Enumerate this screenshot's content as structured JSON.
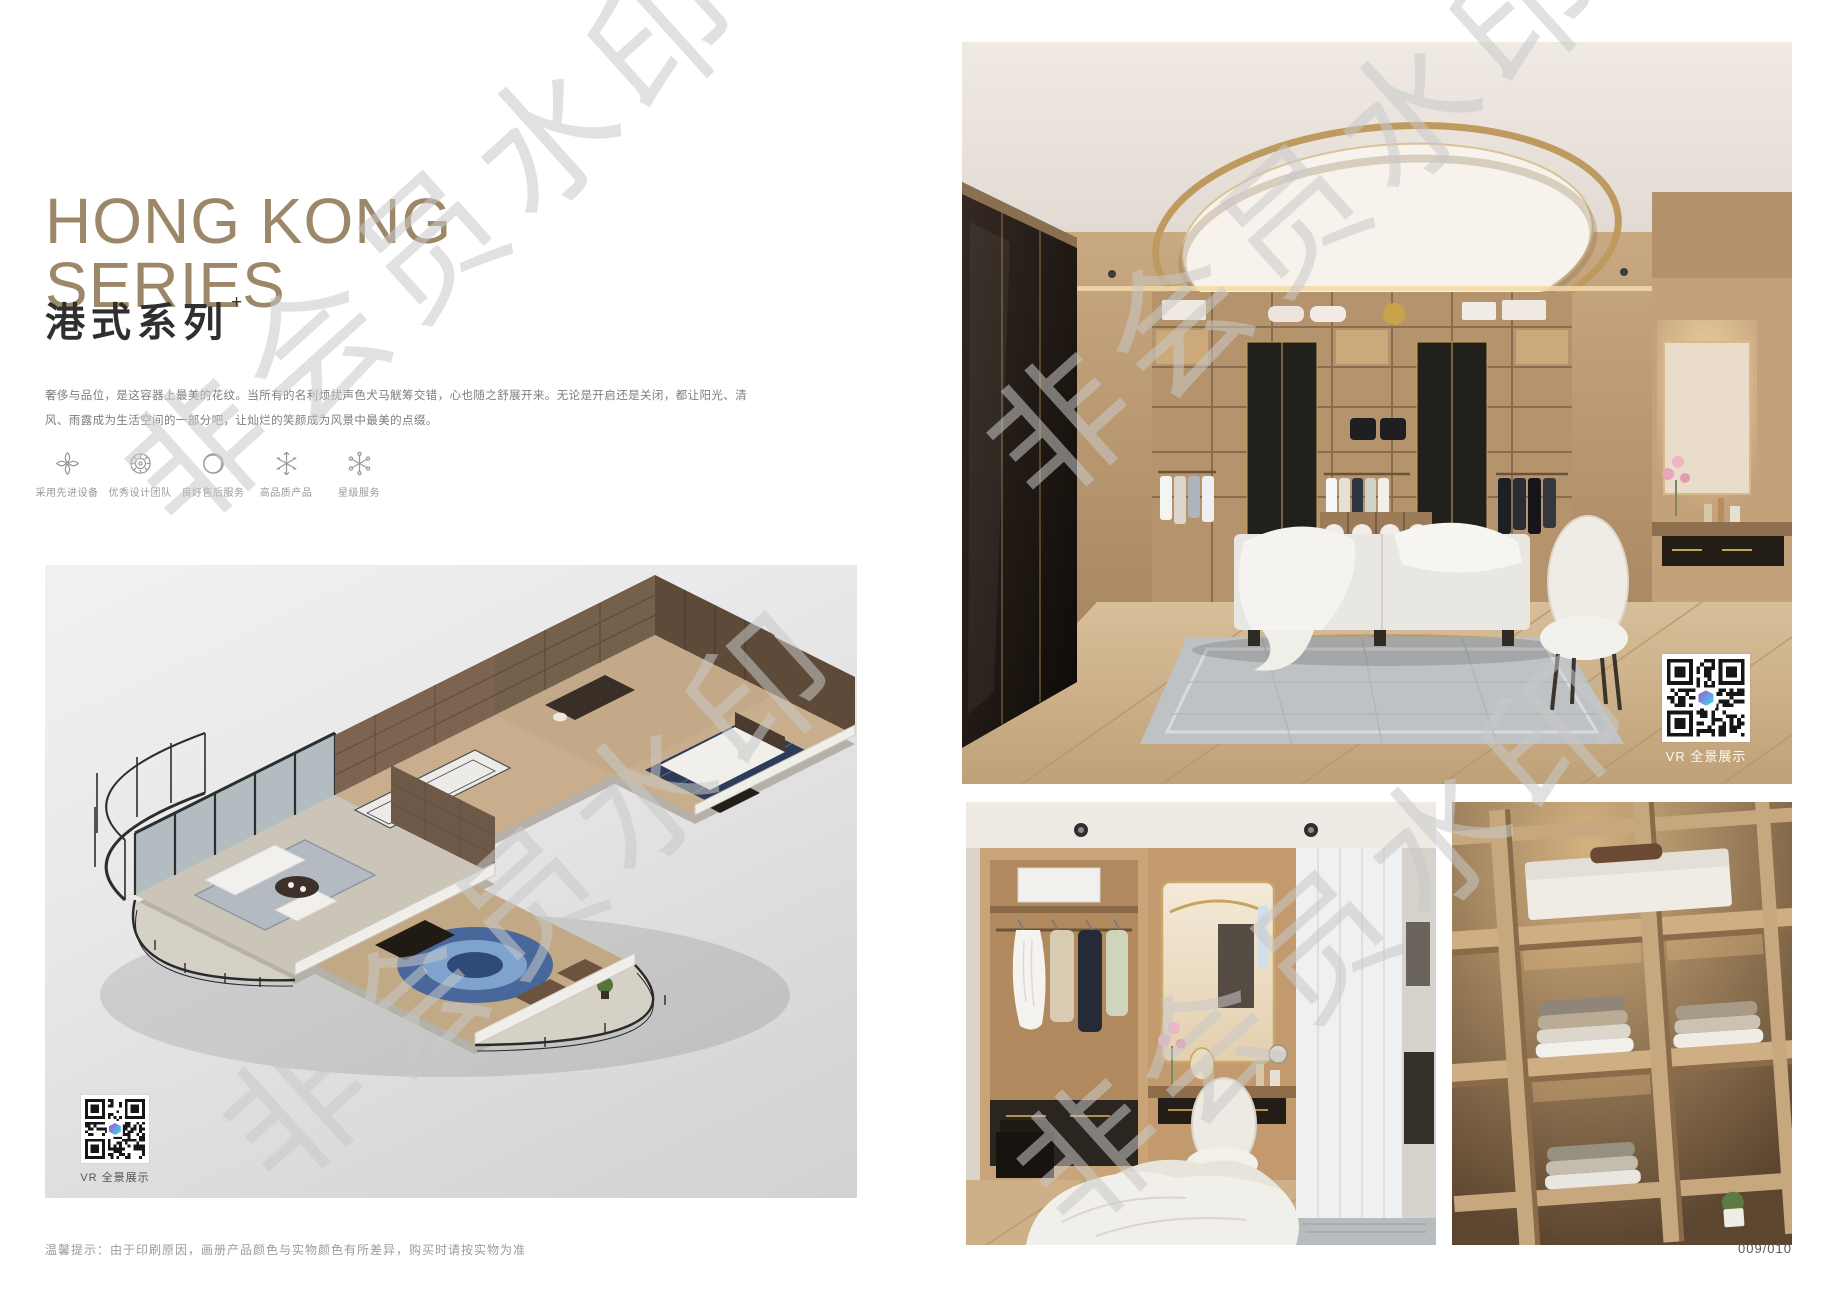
{
  "page": {
    "series_title": {
      "en_line1": "HONG KONG",
      "en_line2": "SERIES",
      "cn": "港式系列",
      "superscript": "+"
    },
    "description": {
      "line1": "奢侈与品位，是这容器上最美的花纹。当所有的名利烦扰声色犬马觥筹交错，心也随之舒展开来。无论是开启还是关闭，都让阳光、清",
      "line2": "风、雨露成为生活空间的一部分吧，让灿烂的笑颜成为风景中最美的点缀。"
    },
    "features": [
      {
        "icon": "ornament-flower-icon",
        "label": "采用先进设备"
      },
      {
        "icon": "rosette-icon",
        "label": "优秀设计团队"
      },
      {
        "icon": "ring-icon",
        "label": "良好售后服务"
      },
      {
        "icon": "snowflake-icon",
        "label": "高品质产品"
      },
      {
        "icon": "star-service-icon",
        "label": "星级服务"
      }
    ],
    "floorplan": {
      "vr_label": "VR 全景展示"
    },
    "main_photo": {
      "vr_label": "VR 全景展示"
    },
    "footer": {
      "note": "温馨提示：由于印刷原因，画册产品颜色与实物颜色有所差异，购买时请按实物为准",
      "page_number": "009/010"
    },
    "watermark": {
      "text": "非会员水印"
    },
    "colors": {
      "title_bronze": "#9d8769",
      "text_dark": "#2f2f2f",
      "text_gray": "#7d7d7d",
      "qr_logo_purple": "#8a6fd8",
      "qr_logo_cyan": "#49c8e8",
      "wood_light": "#c9a981",
      "wood_dark": "#22201a"
    }
  }
}
